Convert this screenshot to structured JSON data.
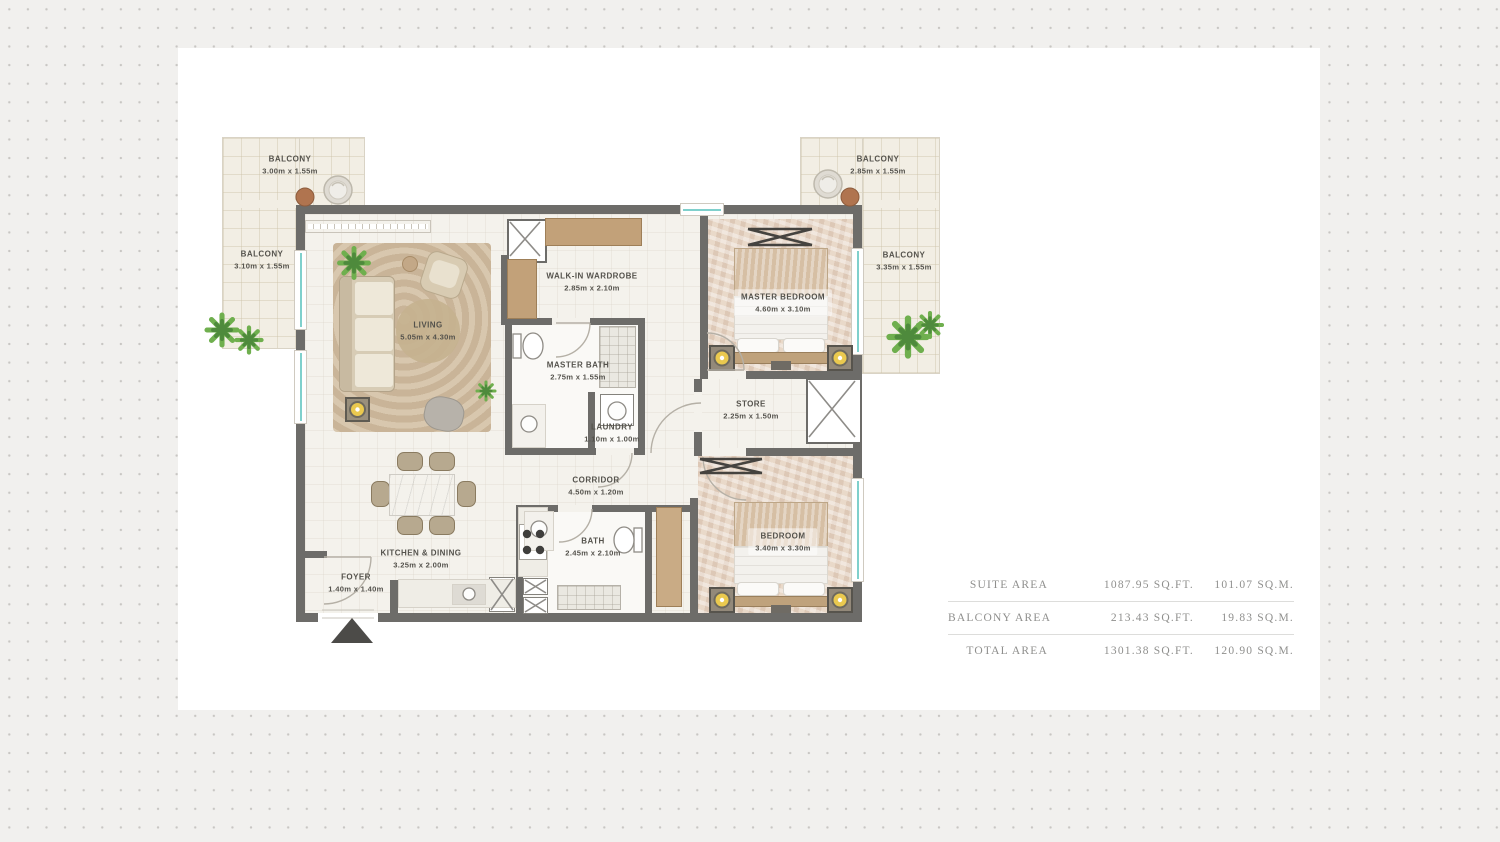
{
  "colors": {
    "wall": "#6d6c69",
    "window_accent": "#7fd0cc",
    "floor": "#f4f2ec",
    "balcony_floor": "#f2eee4",
    "wood": "#c2a179",
    "gold_lamp": "#eac94f",
    "plant_green": "#6faf4e",
    "label_text": "#54524c",
    "table_text": "#8f8f8d"
  },
  "floorplan": {
    "balconies": [
      {
        "name": "BALCONY",
        "dims": "3.00m x 1.55m"
      },
      {
        "name": "BALCONY",
        "dims": "3.10m x 1.55m"
      },
      {
        "name": "BALCONY",
        "dims": "2.85m x 1.55m"
      },
      {
        "name": "BALCONY",
        "dims": "3.35m x 1.55m"
      }
    ],
    "rooms": [
      {
        "name": "LIVING",
        "dims": "5.05m x 4.30m"
      },
      {
        "name": "WALK-IN WARDROBE",
        "dims": "2.85m x 2.10m"
      },
      {
        "name": "MASTER BEDROOM",
        "dims": "4.60m x 3.10m"
      },
      {
        "name": "MASTER BATH",
        "dims": "2.75m x 1.55m"
      },
      {
        "name": "LAUNDRY",
        "dims": "1.10m x 1.00m"
      },
      {
        "name": "STORE",
        "dims": "2.25m x 1.50m"
      },
      {
        "name": "CORRIDOR",
        "dims": "4.50m x 1.20m"
      },
      {
        "name": "KITCHEN & DINING",
        "dims": "3.25m x 2.00m"
      },
      {
        "name": "FOYER",
        "dims": "1.40m x 1.40m"
      },
      {
        "name": "BATH",
        "dims": "2.45m x 2.10m"
      },
      {
        "name": "BEDROOM",
        "dims": "3.40m x 3.30m"
      }
    ]
  },
  "area_table": {
    "rows": [
      {
        "label": "SUITE AREA",
        "sqft": "1087.95 SQ.FT.",
        "sqm": "101.07 SQ.M."
      },
      {
        "label": "BALCONY AREA",
        "sqft": "213.43 SQ.FT.",
        "sqm": "19.83 SQ.M."
      },
      {
        "label": "TOTAL AREA",
        "sqft": "1301.38 SQ.FT.",
        "sqm": "120.90 SQ.M."
      }
    ]
  }
}
